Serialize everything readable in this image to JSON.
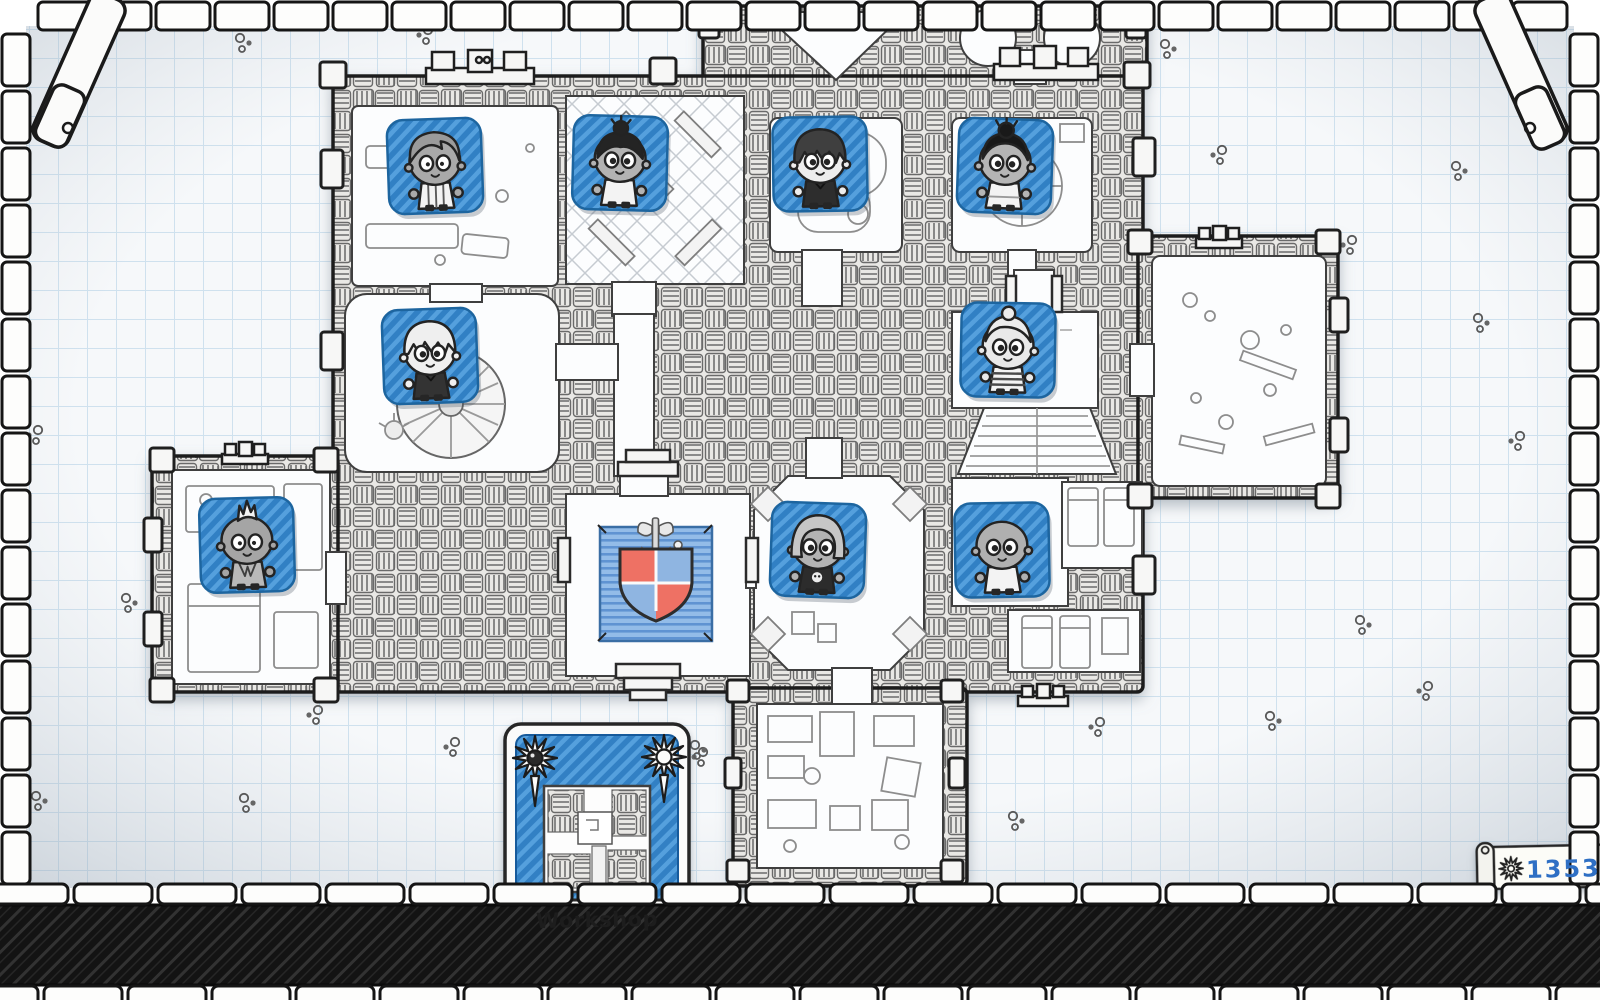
{
  "screen": {
    "name": "guild-map",
    "style": "hand-drawn dungeon blueprint on graph paper"
  },
  "hud": {
    "gold_scroll": {
      "value": "13531",
      "icon": "sunburst-icon"
    },
    "location_card": {
      "label": "Workshop",
      "corner_icons": [
        "sunburst-icon",
        "sunburst-icon"
      ],
      "art": "dungeon-minimap"
    }
  },
  "emblem": {
    "type": "quartered shield with axe crest on blue rug",
    "quarters": [
      "#ee7164",
      "#8fb5e1",
      "#8fb5e1",
      "#ee7164"
    ],
    "rug_blue": "#93bce8"
  },
  "palette": {
    "tile_blue": "#3180c4",
    "tile_blue_light": "#55a0dd",
    "ink": "#1f1f1f",
    "paper": "#f6f8fa",
    "grid_line": "#cfe1ee",
    "score_text": "#2e6fc4"
  },
  "adventurers": [
    {
      "id": "grey-sidepart",
      "desc": "grey side-part hair, striped tunic",
      "x": 435,
      "y": 166,
      "rot": -2,
      "hair": "sidepart",
      "hairColor": "#9b9b9b",
      "skin": "#a9a9a9",
      "eyes": "dot",
      "shirt": "striped-v",
      "shirtColor": "#f3f3f3"
    },
    {
      "id": "topknot",
      "desc": "dark spiky topknot bun, white top",
      "x": 620,
      "y": 163,
      "rot": 1.5,
      "hair": "topknot",
      "hairColor": "#242424",
      "skin": "#b3b3b3",
      "eyes": "heavy",
      "shirt": "white",
      "shirtColor": "#f3f3f3"
    },
    {
      "id": "shaggy",
      "desc": "shaggy dark hair, dark coat",
      "x": 820,
      "y": 164,
      "rot": -1,
      "hair": "shaggy",
      "hairColor": "#3f3f3f",
      "skin": "#ededed",
      "eyes": "heavy",
      "shirt": "dark",
      "shirtColor": "#2d2d2d"
    },
    {
      "id": "black-bun",
      "desc": "black bun, white dress",
      "x": 1005,
      "y": 166,
      "rot": 2,
      "hair": "bun",
      "hairColor": "#191919",
      "skin": "#b5b5b5",
      "eyes": "heavy",
      "shirt": "dress",
      "shirtColor": "#f3f3f3"
    },
    {
      "id": "white-messy",
      "desc": "messy white hair, dark outfit",
      "x": 430,
      "y": 356,
      "rot": -2,
      "hair": "messy",
      "hairColor": "#efefef",
      "skin": "#efefef",
      "eyes": "heavy",
      "shirt": "dark",
      "shirtColor": "#333333"
    },
    {
      "id": "granny",
      "desc": "white-haired granny, striped shirt",
      "x": 1008,
      "y": 350,
      "rot": 1,
      "hair": "granny",
      "hairColor": "#ececec",
      "skin": "#e9e9e9",
      "eyes": "heavy",
      "shirt": "striped-h",
      "shirtColor": "#f3f3f3"
    },
    {
      "id": "mohawk",
      "desc": "white mohawk, grey vest",
      "x": 247,
      "y": 545,
      "rot": -1.5,
      "hair": "mohawk",
      "hairColor": "#f3f3f3",
      "skin": "#a5a5a5",
      "eyes": "dot",
      "shirt": "vest",
      "shirtColor": "#b9b9b9"
    },
    {
      "id": "grey-bob",
      "desc": "grey bob hair, skull shirt",
      "x": 818,
      "y": 550,
      "rot": 2,
      "hair": "bob",
      "hairColor": "#c6c6c6",
      "skin": "#b3b3b3",
      "eyes": "heavy",
      "shirt": "skull",
      "shirtColor": "#2c2c2c"
    },
    {
      "id": "bald",
      "desc": "bald grey adventurer, white top",
      "x": 1002,
      "y": 550,
      "rot": -1,
      "hair": "bald",
      "hairColor": "#aaaaaa",
      "skin": "#b0b0b0",
      "eyes": "heavy",
      "shirt": "white",
      "shirtColor": "#f3f3f3"
    }
  ]
}
